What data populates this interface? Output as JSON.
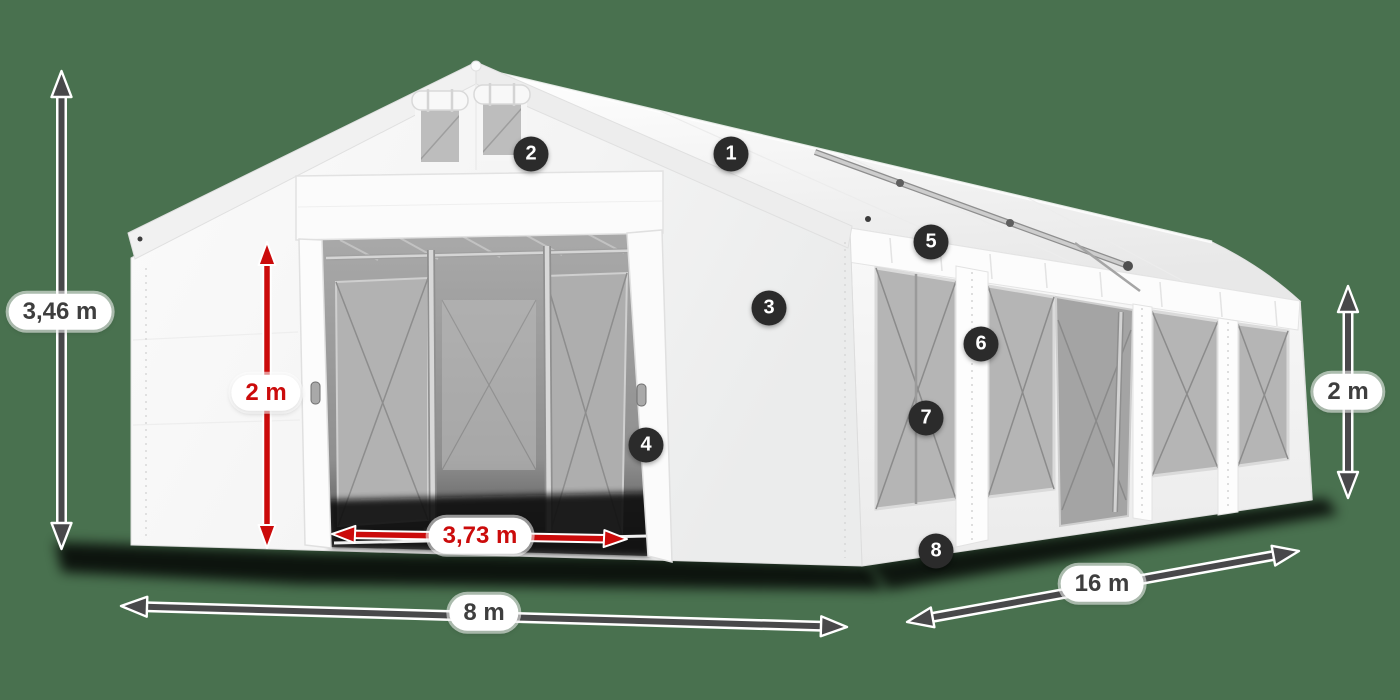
{
  "colors": {
    "background": "#49714F",
    "accent_red": "#CB0B0B",
    "arrow_dark": "#48484A",
    "badge_bg": "#2B2B2B",
    "label_text_dark": "#3E3E3E",
    "tent_white": "#F7F7F7"
  },
  "dimensions": {
    "total_height": "3,46 m",
    "door_height": "2 m",
    "door_clear_width": "3,73 m",
    "front_width": "8 m",
    "length": "16 m",
    "side_wall_height": "2 m"
  },
  "callouts": [
    "1",
    "2",
    "3",
    "4",
    "5",
    "6",
    "7",
    "8"
  ]
}
